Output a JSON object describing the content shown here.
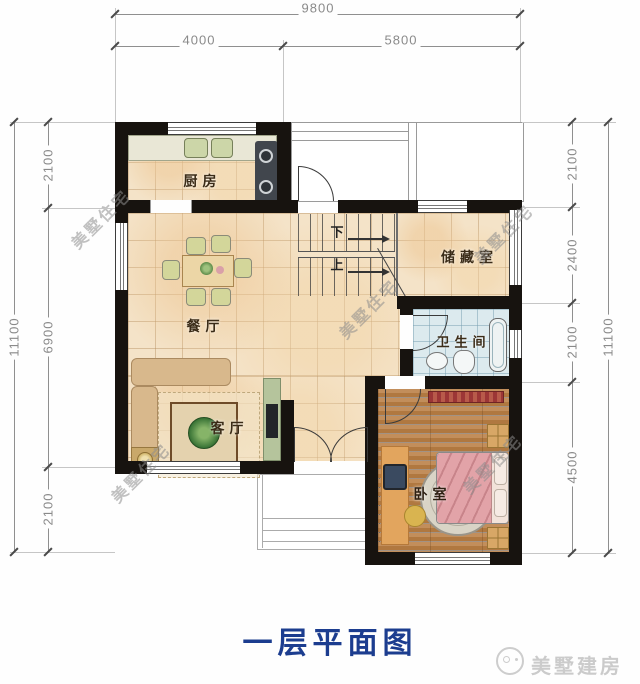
{
  "title": "一层平面图",
  "brand": {
    "name": "美墅建房",
    "icon": "house-circle-logo"
  },
  "watermark": {
    "text": "美墅住宅"
  },
  "dimensions": {
    "top": {
      "total": "9800",
      "segments": [
        "4000",
        "5800"
      ]
    },
    "left": {
      "total": "11100",
      "segments": [
        "2100",
        "6900",
        "2100"
      ]
    },
    "right": {
      "total": "11100",
      "segments": [
        "2100",
        "2400",
        "2100",
        "4500"
      ]
    }
  },
  "rooms": {
    "kitchen": "厨房",
    "dining": "餐厅",
    "living": "客厅",
    "storage": "储藏室",
    "bathroom": "卫生间",
    "bedroom": "卧室"
  },
  "stairs": {
    "down": "下",
    "up": "上"
  },
  "colors": {
    "title_blue": "#1c3d8f",
    "wall_black": "#17130f",
    "tile_floor": "#f4e3c8",
    "bath_floor": "#dceaee",
    "wood_floor": "#b98352",
    "bed_pink": "#e2a3a8",
    "watermark_gray": "#8c8c8c"
  }
}
